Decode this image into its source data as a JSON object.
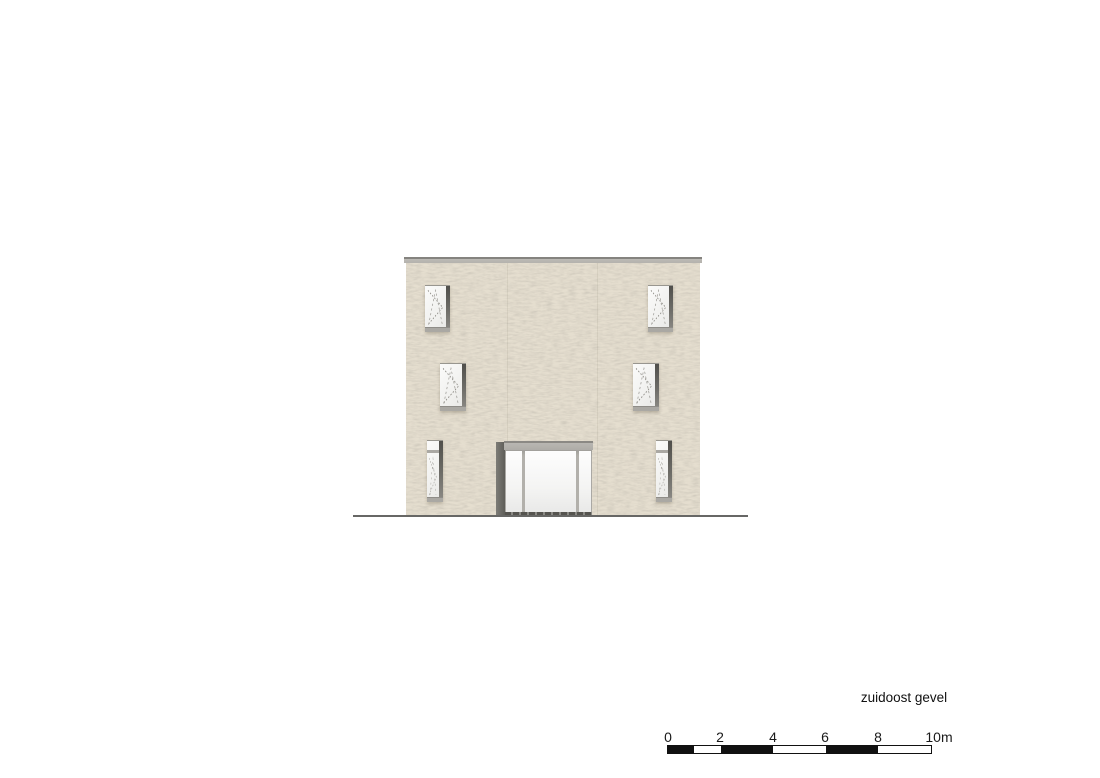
{
  "drawing": {
    "caption": "zuidoost gevel",
    "scale_bar": {
      "tick_labels": [
        "0",
        "2",
        "4",
        "6",
        "8",
        "10m"
      ],
      "total_meters": 10,
      "segment_pattern": "black 0-1m, white 1-2m, black 2-4m, white 4-6m, black 6-8m, white 8-10m"
    },
    "colors": {
      "background": "#ffffff",
      "facade": "#e5decf",
      "facade_speckle": "#9e9480",
      "roof_band": "#b9b7b2",
      "window_glass": "#f6f6f5",
      "window_jamb_dark": "#5e5d58",
      "window_sill": "#aaa8a3",
      "entrance_canopy": "#b5b3ae",
      "entrance_reveal": "#6b6a65",
      "ground_line": "#676765",
      "scale_black": "#111111",
      "text": "#111111"
    }
  }
}
